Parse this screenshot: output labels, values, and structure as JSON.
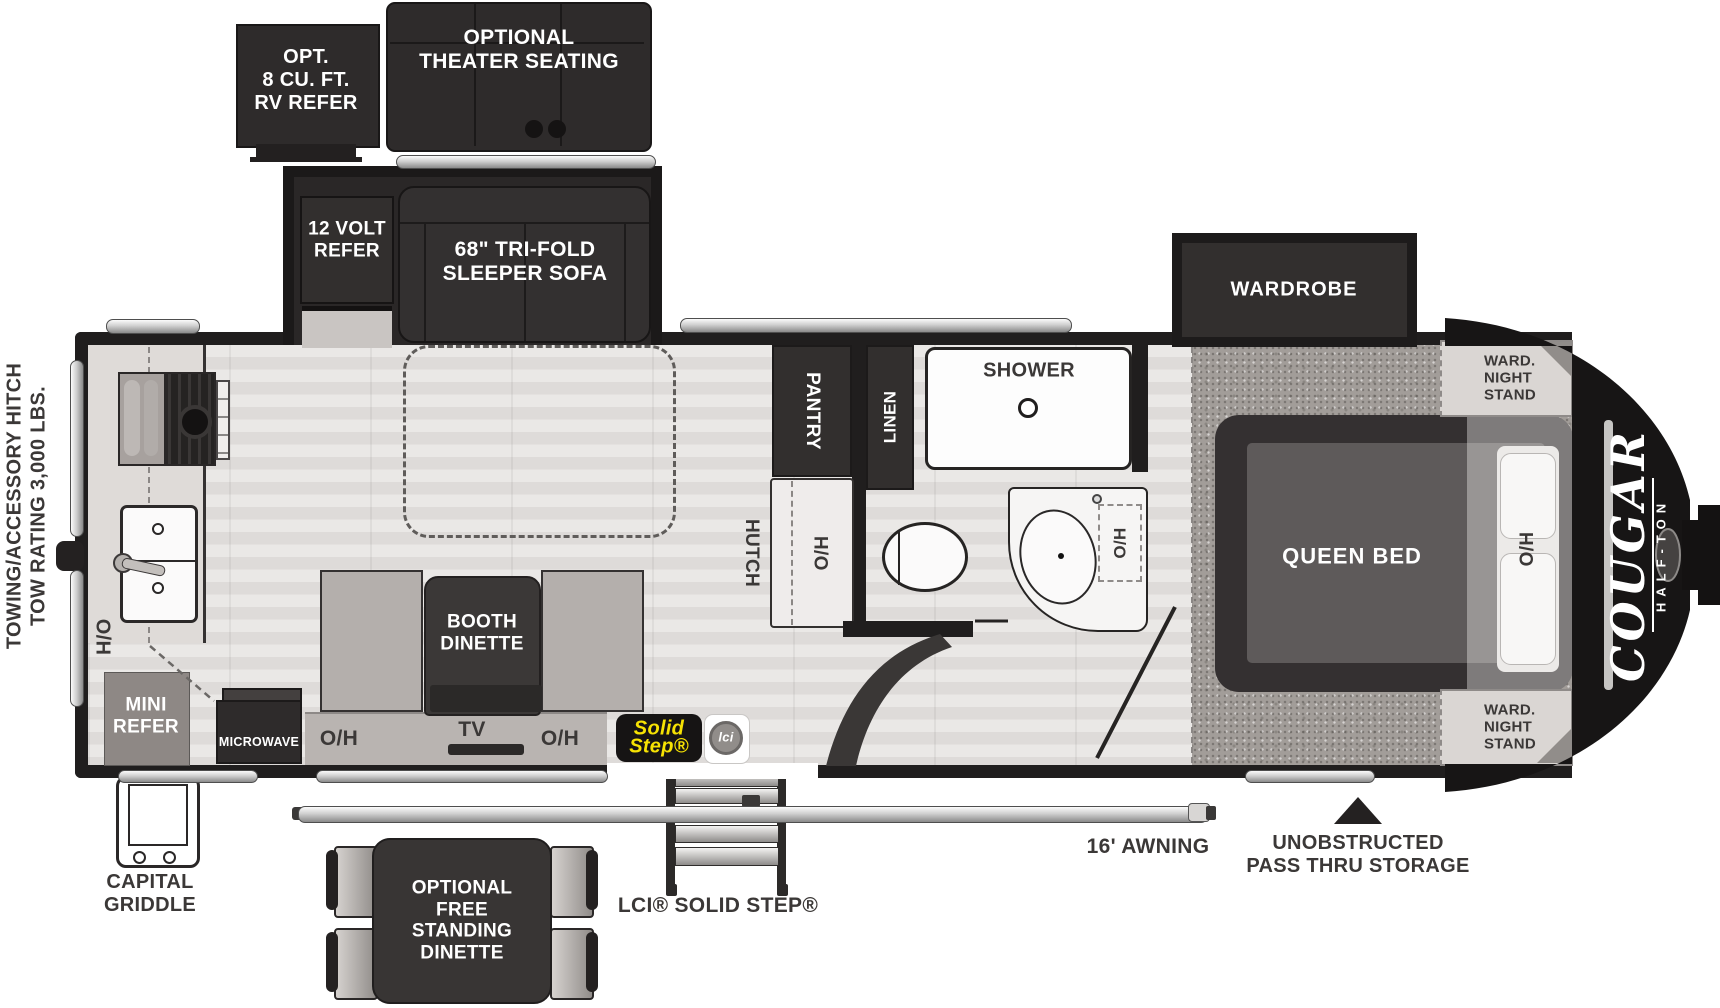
{
  "colors": {
    "wall": "#201e1e",
    "dark_box": "#2e2b2b",
    "floor_wood": "#e4e1df",
    "carpet": "#a29d99",
    "badge_yellow": "#f6e203",
    "label_dark": "#3b3837"
  },
  "exterior": {
    "hitch_label": [
      "TOWING/ACCESSORY HITCH",
      "TOW RATING 3,000 LBS."
    ],
    "opt_refer": [
      "OPT.",
      "8 CU. FT.",
      "RV REFER"
    ],
    "theater": [
      "OPTIONAL",
      "THEATER SEATING"
    ],
    "capital_griddle": [
      "CAPITAL",
      "GRIDDLE"
    ],
    "free_dinette": [
      "OPTIONAL",
      "FREE",
      "STANDING",
      "DINETTE"
    ],
    "lci_solid_step": "LCI® SOLID STEP®",
    "awning": "16' AWNING",
    "pass_thru": [
      "UNOBSTRUCTED",
      "PASS THRU STORAGE"
    ]
  },
  "slideout": {
    "refer": [
      "12 VOLT",
      "REFER"
    ],
    "sofa": [
      "68\" TRI-FOLD",
      "SLEEPER SOFA"
    ]
  },
  "kitchen": {
    "overhead": "O/H",
    "mini_refer": [
      "MINI",
      "REFER"
    ],
    "microwave": "MICROWAVE"
  },
  "living": {
    "booth": [
      "BOOTH",
      "DINETTE"
    ],
    "tv": "TV",
    "overhead_left": "O/H",
    "overhead_right": "O/H"
  },
  "storage": {
    "pantry": "PANTRY",
    "linen": "LINEN",
    "hutch": "HUTCH",
    "hutch_overhead": "O/H"
  },
  "bathroom": {
    "shower": "SHOWER",
    "sink_overhead": "O/H"
  },
  "bedroom": {
    "wardrobe": "WARDROBE",
    "queen_bed": "QUEEN BED",
    "overhead": "O/H",
    "nightstand_top": [
      "WARD.",
      "NIGHT",
      "STAND"
    ],
    "nightstand_bottom": [
      "WARD.",
      "NIGHT",
      "STAND"
    ]
  },
  "brand": {
    "name": "COUGAR",
    "series": "HALF-TON"
  },
  "badges": {
    "solid_step": [
      "Solid",
      "Step®"
    ],
    "lci": "lci"
  }
}
